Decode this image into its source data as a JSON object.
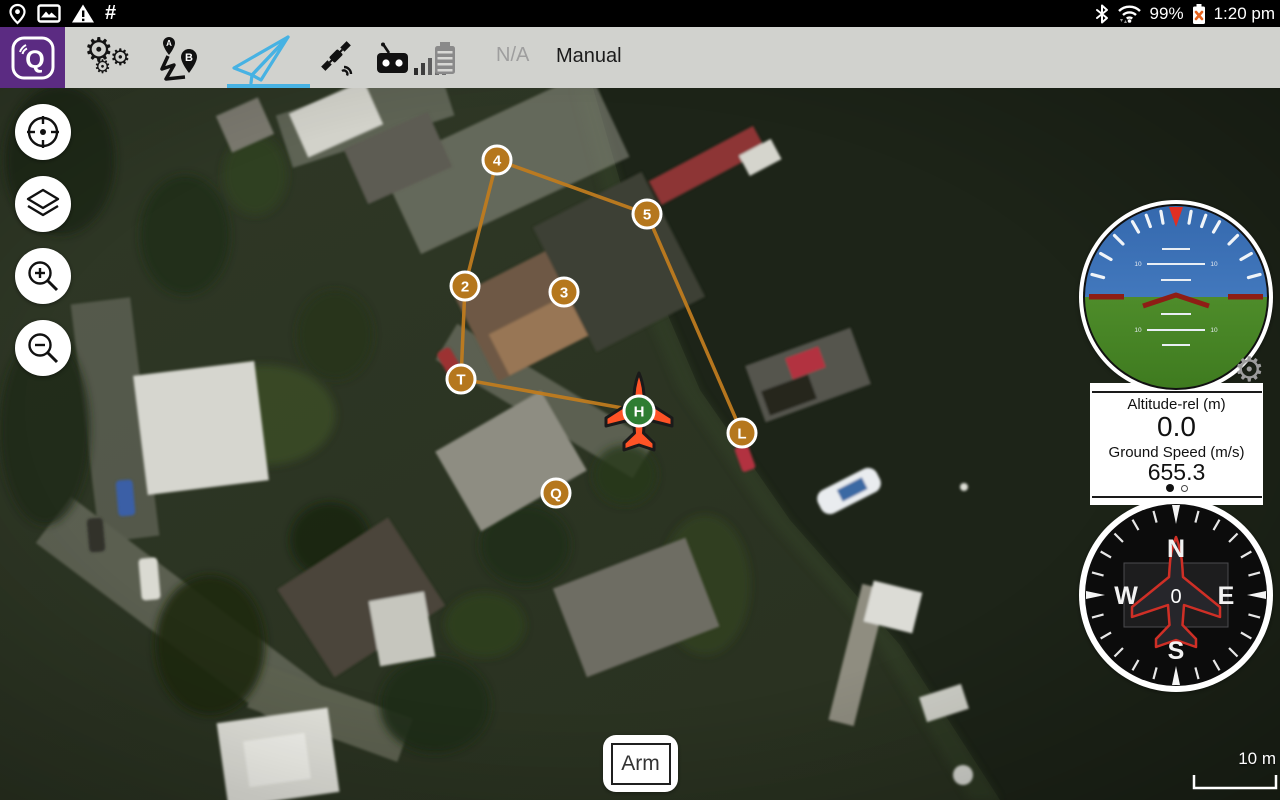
{
  "status_bar": {
    "left_icons": [
      "location-pin",
      "screenshot",
      "warning",
      "hash"
    ],
    "hash_symbol": "#",
    "battery_percent": "99%",
    "time": "1:20 pm"
  },
  "toolbar": {
    "logo_letter": "Q",
    "tabs": [
      "settings",
      "plan",
      "fly",
      "satellite",
      "rc-link"
    ],
    "active_tab": "fly",
    "accent_color": "#47b2e3",
    "battery_status": "N/A",
    "flight_mode": "Manual"
  },
  "map": {
    "scale_label": "10 m",
    "path_color": "#bf7c1f",
    "marker_fill": "#b5771d",
    "marker_stroke": "#ffffff",
    "home_fill": "#2e7d32",
    "drone_fill": "#ff5326",
    "waypoints": [
      {
        "label": "4",
        "x": 497,
        "y": 160
      },
      {
        "label": "5",
        "x": 647,
        "y": 214
      },
      {
        "label": "2",
        "x": 465,
        "y": 286
      },
      {
        "label": "3",
        "x": 564,
        "y": 292
      },
      {
        "label": "T",
        "x": 461,
        "y": 379
      },
      {
        "label": "L",
        "x": 742,
        "y": 433
      },
      {
        "label": "Q",
        "x": 556,
        "y": 493
      }
    ],
    "home": {
      "label": "H",
      "x": 639,
      "y": 411
    },
    "path_segments": [
      [
        "2",
        "4"
      ],
      [
        "4",
        "5"
      ],
      [
        "5",
        "L"
      ],
      [
        "2",
        "T"
      ],
      [
        "T",
        "H"
      ]
    ]
  },
  "map_controls": [
    "center-map",
    "map-layers",
    "zoom-in",
    "zoom-out"
  ],
  "instruments": {
    "attitude": {
      "pitch_label": "10"
    },
    "altitude_label": "Altitude-rel (m)",
    "altitude_value": "0.0",
    "ground_speed_label": "Ground Speed (m/s)",
    "ground_speed_value": "655.3",
    "pager": {
      "count": 2,
      "active": 0
    },
    "compass_heading": "0",
    "compass_labels": {
      "n": "N",
      "e": "E",
      "s": "S",
      "w": "W"
    }
  },
  "arm_button_label": "Arm"
}
